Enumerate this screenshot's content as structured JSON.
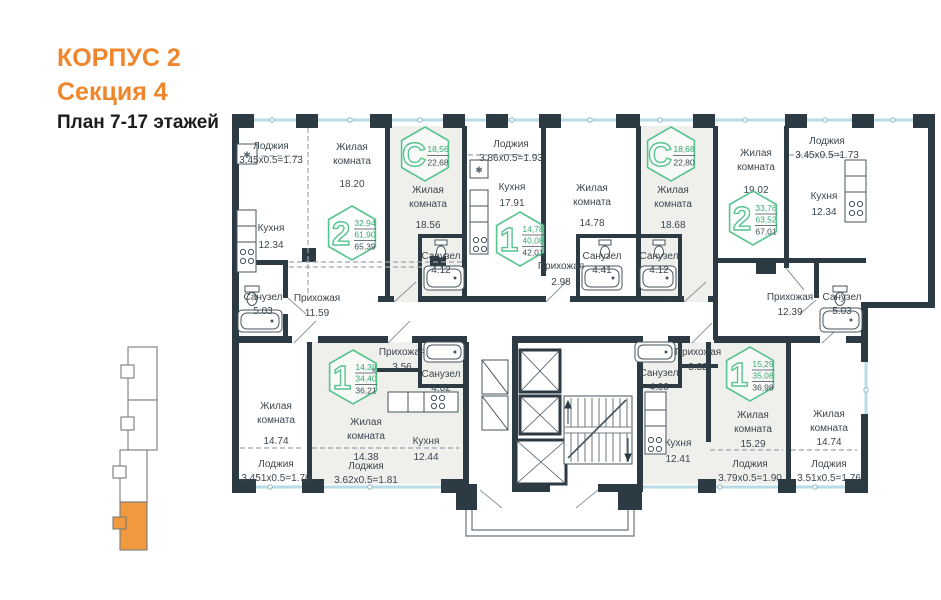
{
  "header": {
    "building": "КОРПУС 2",
    "section": "Секция 4",
    "floors": "План 7-17 этажей"
  },
  "colors": {
    "accent_orange": "#F0862B",
    "badge_green_stroke": "#57C38F",
    "badge_green_text": "#35A871",
    "badge_dark_text": "#3E4C55",
    "wall_dark": "#2C3A43",
    "glazing_blue": "#B9DBE8",
    "room_shade": "#EFF0EC"
  },
  "badges": [
    {
      "glyph": "2",
      "values": [
        "32,94",
        "61,90",
        "65,39"
      ],
      "x": 352,
      "y": 233
    },
    {
      "glyph": "С",
      "values": [
        "18,56",
        "22,68"
      ],
      "x": 425,
      "y": 154
    },
    {
      "glyph": "1",
      "values": [
        "14,78",
        "40,08",
        "42,01"
      ],
      "x": 520,
      "y": 239
    },
    {
      "glyph": "С",
      "values": [
        "18,68",
        "22,80"
      ],
      "x": 671,
      "y": 154
    },
    {
      "glyph": "2",
      "values": [
        "33,76",
        "63,52",
        "67,01"
      ],
      "x": 753,
      "y": 218
    },
    {
      "glyph": "1",
      "values": [
        "14,38",
        "34,40",
        "36,21"
      ],
      "x": 353,
      "y": 377
    },
    {
      "glyph": "1",
      "values": [
        "15,29",
        "35,08",
        "36,98"
      ],
      "x": 750,
      "y": 374
    }
  ],
  "labels": [
    {
      "t": "Лоджия",
      "x": 271,
      "y": 149
    },
    {
      "t": "3.45х0.5=1.73",
      "x": 271,
      "y": 163
    },
    {
      "t": "Жилая",
      "x": 352,
      "y": 150
    },
    {
      "t": "комната",
      "x": 352,
      "y": 164
    },
    {
      "t": "18.20",
      "x": 352,
      "y": 187
    },
    {
      "t": "Кухня",
      "x": 271,
      "y": 231
    },
    {
      "t": "12.34",
      "x": 271,
      "y": 248
    },
    {
      "t": "Жилая",
      "x": 428,
      "y": 193
    },
    {
      "t": "комната",
      "x": 428,
      "y": 207
    },
    {
      "t": "18.56",
      "x": 428,
      "y": 228
    },
    {
      "t": "Санузел",
      "x": 441,
      "y": 259
    },
    {
      "t": "4.12",
      "x": 441,
      "y": 273
    },
    {
      "t": "Лоджия",
      "x": 511,
      "y": 147
    },
    {
      "t": "3.86х0.5=1.93",
      "x": 511,
      "y": 161
    },
    {
      "t": "Кухня",
      "x": 512,
      "y": 190
    },
    {
      "t": "17.91",
      "x": 512,
      "y": 206
    },
    {
      "t": "Прихожая",
      "x": 561,
      "y": 269
    },
    {
      "t": "2.98",
      "x": 561,
      "y": 285
    },
    {
      "t": "Жилая",
      "x": 592,
      "y": 191
    },
    {
      "t": "комната",
      "x": 592,
      "y": 205
    },
    {
      "t": "14.78",
      "x": 592,
      "y": 226
    },
    {
      "t": "Санузел",
      "x": 602,
      "y": 259
    },
    {
      "t": "4.41",
      "x": 602,
      "y": 273
    },
    {
      "t": "Санузел",
      "x": 659,
      "y": 259
    },
    {
      "t": "4.12",
      "x": 659,
      "y": 273
    },
    {
      "t": "Жилая",
      "x": 673,
      "y": 193
    },
    {
      "t": "комната",
      "x": 673,
      "y": 207
    },
    {
      "t": "18.68",
      "x": 673,
      "y": 228
    },
    {
      "t": "Жилая",
      "x": 756,
      "y": 156
    },
    {
      "t": "комната",
      "x": 756,
      "y": 170
    },
    {
      "t": "19.02",
      "x": 756,
      "y": 193
    },
    {
      "t": "Лоджия",
      "x": 827,
      "y": 144
    },
    {
      "t": "3.45х0.5=1.73",
      "x": 827,
      "y": 158
    },
    {
      "t": "Кухня",
      "x": 824,
      "y": 199
    },
    {
      "t": "12.34",
      "x": 824,
      "y": 215
    },
    {
      "t": "Санузел",
      "x": 263,
      "y": 300
    },
    {
      "t": "5.03",
      "x": 263,
      "y": 314
    },
    {
      "t": "Прихожая",
      "x": 317,
      "y": 301
    },
    {
      "t": "11.59",
      "x": 317,
      "y": 316
    },
    {
      "t": "Прихожая",
      "x": 790,
      "y": 300
    },
    {
      "t": "12.39",
      "x": 790,
      "y": 315
    },
    {
      "t": "Санузел",
      "x": 842,
      "y": 300
    },
    {
      "t": "5.03",
      "x": 842,
      "y": 314
    },
    {
      "t": "Прихожая",
      "x": 402,
      "y": 355
    },
    {
      "t": "3.56",
      "x": 402,
      "y": 370
    },
    {
      "t": "Санузел",
      "x": 441,
      "y": 377
    },
    {
      "t": "4.02",
      "x": 441,
      "y": 391
    },
    {
      "t": "Жилая",
      "x": 276,
      "y": 409
    },
    {
      "t": "комната",
      "x": 276,
      "y": 423
    },
    {
      "t": "14.74",
      "x": 276,
      "y": 444
    },
    {
      "t": "Лоджия",
      "x": 276,
      "y": 467
    },
    {
      "t": "3.451х0.5=1.76",
      "x": 276,
      "y": 481
    },
    {
      "t": "Жилая",
      "x": 366,
      "y": 425
    },
    {
      "t": "комната",
      "x": 366,
      "y": 439
    },
    {
      "t": "14.38",
      "x": 366,
      "y": 460
    },
    {
      "t": "Лоджия",
      "x": 366,
      "y": 469
    },
    {
      "t": "3.62х0.5=1.81",
      "x": 366,
      "y": 483
    },
    {
      "t": "Кухня",
      "x": 426,
      "y": 444
    },
    {
      "t": "12.44",
      "x": 426,
      "y": 460
    },
    {
      "t": "Санузел",
      "x": 659,
      "y": 376
    },
    {
      "t": "4.06",
      "x": 659,
      "y": 390
    },
    {
      "t": "Прихожая",
      "x": 698,
      "y": 355
    },
    {
      "t": "3.32",
      "x": 698,
      "y": 370
    },
    {
      "t": "Кухня",
      "x": 678,
      "y": 446
    },
    {
      "t": "12.41",
      "x": 678,
      "y": 462
    },
    {
      "t": "Жилая",
      "x": 753,
      "y": 418
    },
    {
      "t": "комната",
      "x": 753,
      "y": 432
    },
    {
      "t": "15.29",
      "x": 753,
      "y": 447
    },
    {
      "t": "Лоджия",
      "x": 750,
      "y": 467
    },
    {
      "t": "3.79х0.5=1.90",
      "x": 750,
      "y": 481
    },
    {
      "t": "Жилая",
      "x": 829,
      "y": 417
    },
    {
      "t": "комната",
      "x": 829,
      "y": 431
    },
    {
      "t": "14.74",
      "x": 829,
      "y": 445
    },
    {
      "t": "Лоджия",
      "x": 829,
      "y": 467
    },
    {
      "t": "3.51х0.5=1.76",
      "x": 829,
      "y": 481
    }
  ],
  "minimap": {
    "sections": [
      {
        "name": "section-1",
        "highlighted": false
      },
      {
        "name": "section-2",
        "highlighted": false
      },
      {
        "name": "section-3",
        "highlighted": false
      },
      {
        "name": "section-4",
        "highlighted": true
      }
    ],
    "highlight_color": "#F0993F"
  }
}
